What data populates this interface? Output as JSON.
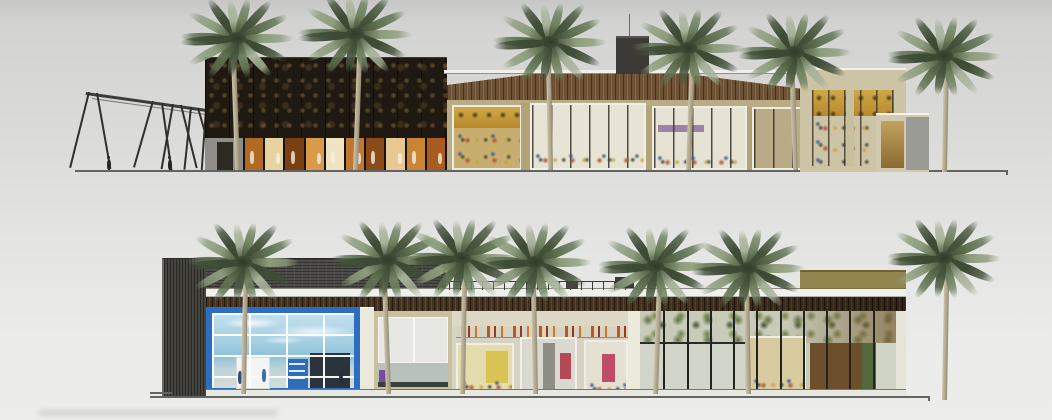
{
  "scene_type": "architectural-elevation-rendering",
  "palette": {
    "background_top": "#c7c8c6",
    "background_bottom": "#ededeb",
    "line": "#63635f",
    "dark_facade": "#1f1911",
    "wood_fascia": "#6e5236",
    "charcoal_slats": "#4e4c48",
    "soffit_wood": "#46331f",
    "blue_frame": "#2c6fc1",
    "blue_glass": "#a5cfe3",
    "beige_wall": "#cdc4a5",
    "amber_interior": "#c8a23f",
    "palm_green": "#6f8260",
    "palm_dark": "#3f4c36",
    "palm_light": "#a7b29a",
    "palm_trunk": "#c0b69c"
  },
  "upper_elevation": {
    "ground": {
      "x1": 75,
      "x2": 1008,
      "y": 170
    },
    "canopy": {
      "beam_x": 86,
      "beam_y": 92,
      "beam_length": 122,
      "slope_deg": 8,
      "struts": [
        {
          "x": 88,
          "a": 14
        },
        {
          "x": 96,
          "a": -10
        },
        {
          "x": 152,
          "a": 16
        },
        {
          "x": 161,
          "a": -8
        },
        {
          "x": 172,
          "a": 10
        },
        {
          "x": 180,
          "a": -14
        },
        {
          "x": 190,
          "a": 6
        },
        {
          "x": 197,
          "a": -16
        },
        {
          "x": 205,
          "a": 4
        },
        {
          "x": 213,
          "a": -10
        },
        {
          "x": 222,
          "a": 12
        },
        {
          "x": 231,
          "a": -8
        }
      ],
      "pedestrians": [
        {
          "x": 107
        },
        {
          "x": 168
        }
      ]
    },
    "storefront_pane_tints": [
      "#b06a24",
      "#e8d2a0",
      "#7c3f14",
      "#d99a4a",
      "#efe3c0",
      "#c07830",
      "#8a4a1a",
      "#e6c890",
      "#c98434",
      "#a85c20"
    ],
    "palms": [
      {
        "cx": 237,
        "cy": 38,
        "ground": 170,
        "lean": -2
      },
      {
        "cx": 355,
        "cy": 34,
        "ground": 170,
        "lean": 2
      },
      {
        "cx": 550,
        "cy": 42,
        "ground": 170,
        "lean": -1
      },
      {
        "cx": 688,
        "cy": 48,
        "ground": 170,
        "lean": 2
      },
      {
        "cx": 795,
        "cy": 52,
        "ground": 170,
        "lean": -2
      },
      {
        "cx": 944,
        "cy": 56,
        "ground": 172,
        "lean": 1
      }
    ]
  },
  "lower_elevation": {
    "ground": {
      "x1": 150,
      "x2": 930,
      "y": 396
    },
    "hall_mullion_count": 10,
    "store_figures": [
      {
        "x": 26,
        "y": 58,
        "c": "#2d4e76"
      },
      {
        "x": 50,
        "y": 56,
        "c": "#3a6ea8"
      },
      {
        "x": 127,
        "y": 60,
        "c": "#23303c"
      }
    ],
    "palms": [
      {
        "cx": 243,
        "cy": 262,
        "ground": 394,
        "lean": 1
      },
      {
        "cx": 388,
        "cy": 260,
        "ground": 394,
        "lean": -2
      },
      {
        "cx": 462,
        "cy": 258,
        "ground": 394,
        "lean": 1
      },
      {
        "cx": 535,
        "cy": 262,
        "ground": 394,
        "lean": -1
      },
      {
        "cx": 655,
        "cy": 266,
        "ground": 394,
        "lean": 2
      },
      {
        "cx": 748,
        "cy": 268,
        "ground": 394,
        "lean": -1
      },
      {
        "cx": 944,
        "cy": 258,
        "ground": 400,
        "lean": 1
      }
    ]
  }
}
